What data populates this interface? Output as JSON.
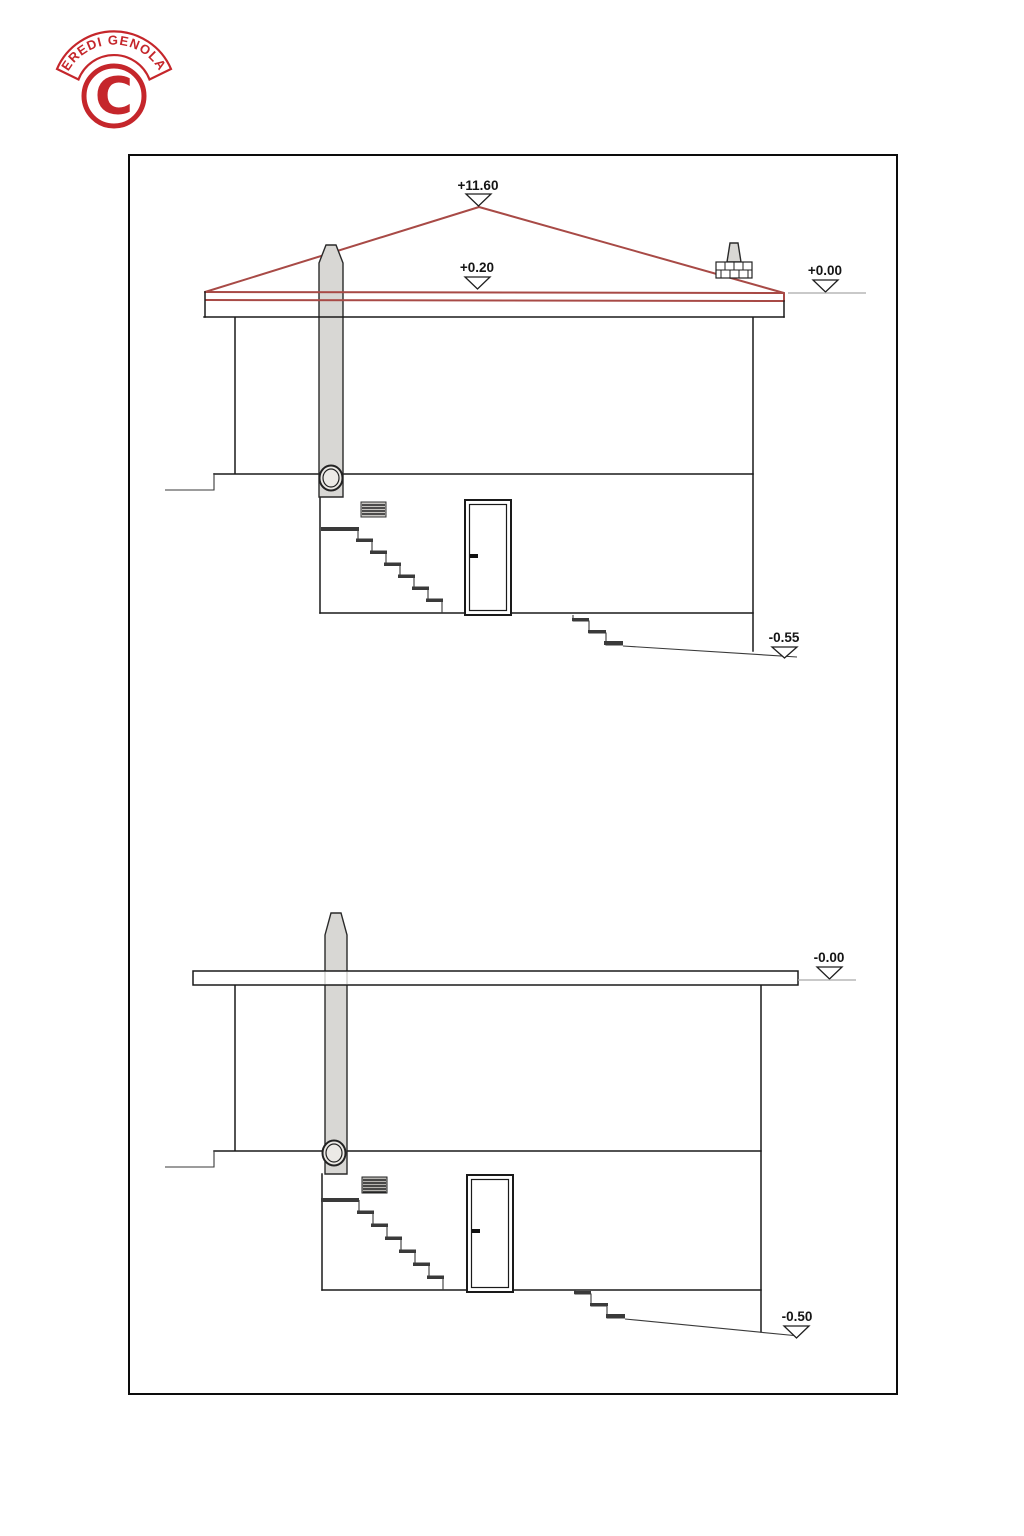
{
  "logo": {
    "arc_text": "EREDI GENOLA",
    "monogram": "C"
  },
  "upper": {
    "markers": {
      "ridge": "+11.60",
      "eave": "+0.20",
      "ground": "+0.00",
      "yard": "-0.55"
    }
  },
  "lower": {
    "markers": {
      "ground": "-0.00",
      "yard": "-0.50"
    }
  },
  "colors": {
    "stamp_red": "#c5262b",
    "roof_red": "#a84a46",
    "drawing_line": "#1a1a1a",
    "chimney_gray": "#d8d7d4",
    "marker_line": "#a9a9a9"
  }
}
